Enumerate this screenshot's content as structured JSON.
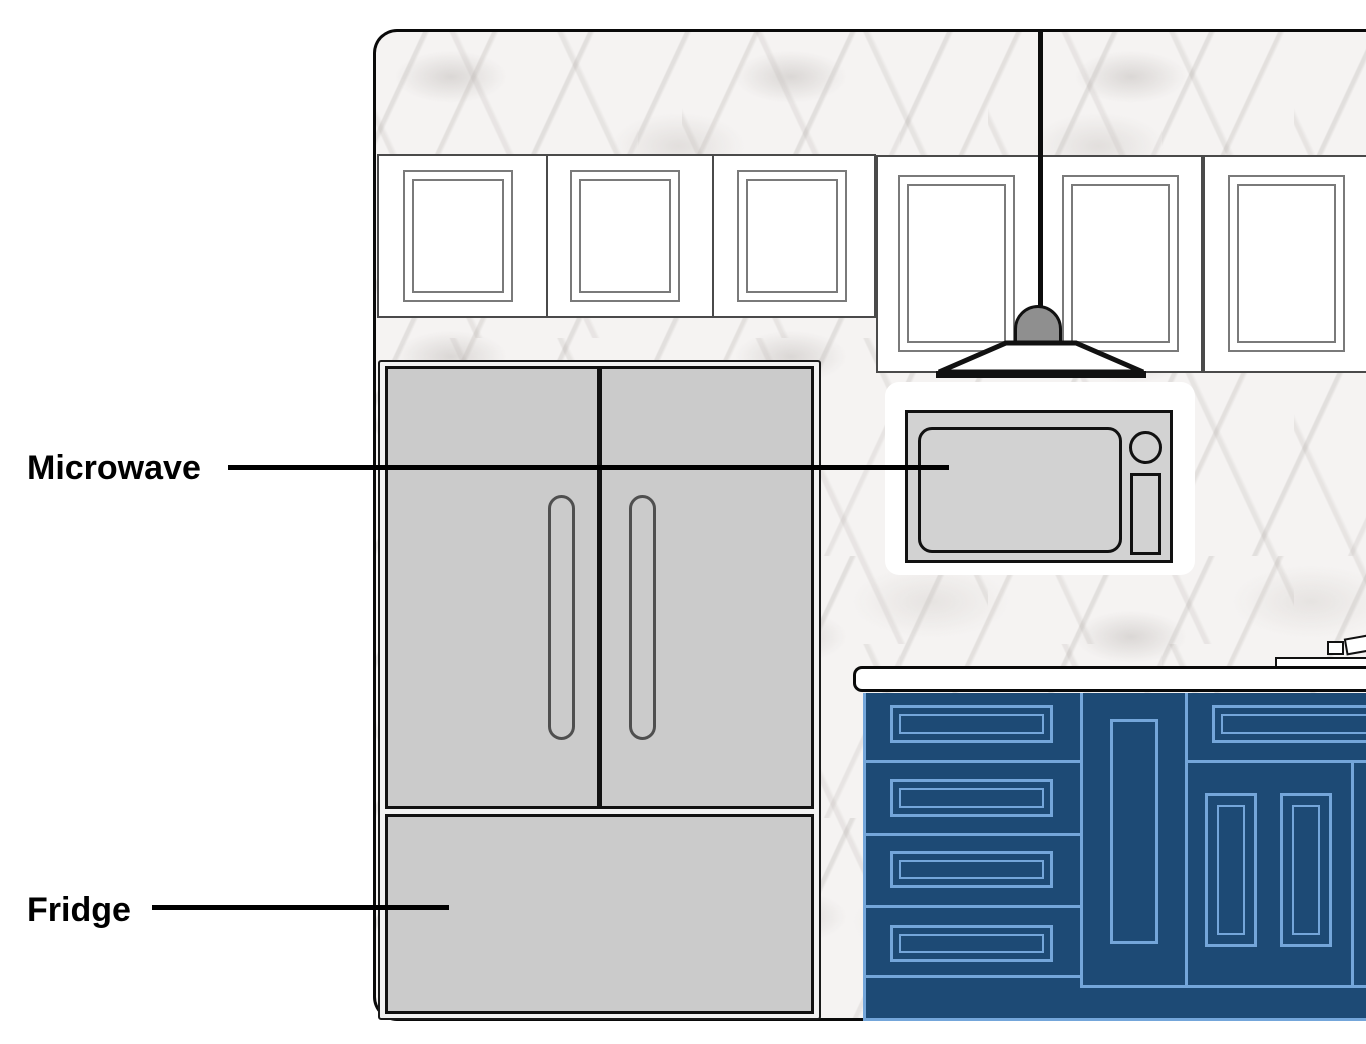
{
  "diagram": {
    "type": "kitchen-elevation-diagram",
    "labels": {
      "microwave": "Microwave",
      "fridge": "Fridge"
    },
    "parts": {
      "wall": "marble backsplash wall",
      "upper_cabinets": "white shaker upper cabinets",
      "pendant": "pendant lamp",
      "microwave": "countertop microwave in alcove",
      "countertop": "white countertop",
      "cooktop": "gas cooktop edge",
      "base_cabinets": "navy base cabinets with drawers",
      "fridge": "french-door refrigerator with bottom freezer"
    },
    "colors": {
      "background": "#ffffff",
      "wall_marble": "#f5f3f2",
      "outline_black": "#0d0d0d",
      "cabinet_white": "#ffffff",
      "cabinet_frame_gray": "#7a7a7a",
      "appliance_gray": "#cbcbcb",
      "microwave_gray": "#d2d2d2",
      "lamp_dome_gray": "#8f8f8f",
      "base_cabinet_navy": "#1d4a75",
      "base_cabinet_line_blue": "#74a6da"
    }
  }
}
